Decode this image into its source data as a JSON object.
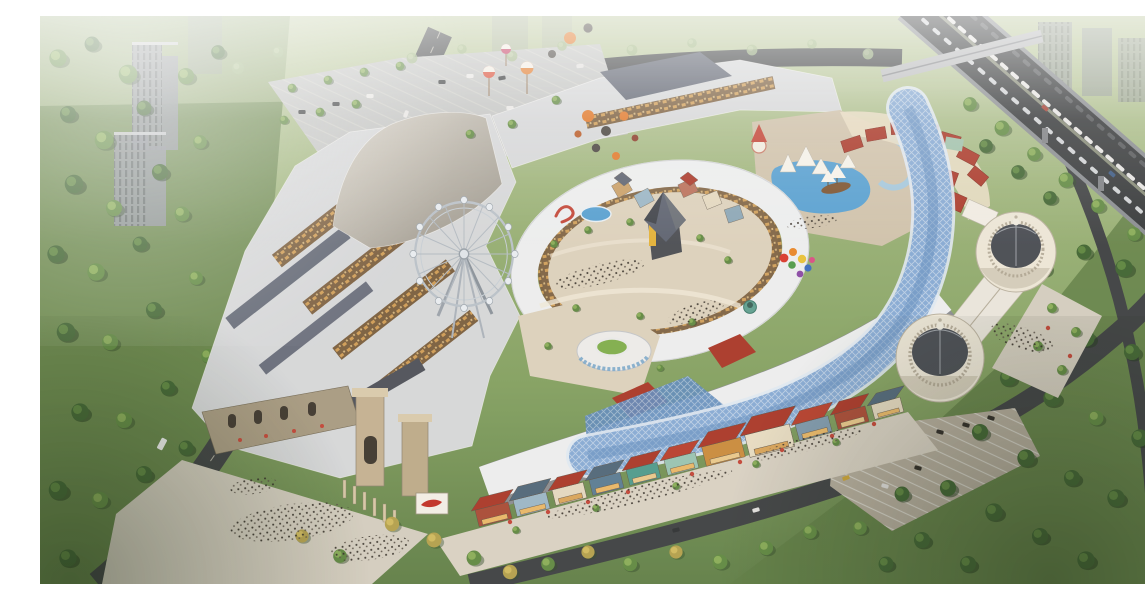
{
  "image": {
    "type": "aerial-architectural-rendering",
    "subject": "Bird's-eye rendering of a large mixed-use shopping and entertainment complex",
    "time_of_day": "late afternoon with warm hazy sunlight from the left",
    "visible_text": "none"
  },
  "scene": {
    "complex_landmarks": [
      {
        "name": "ferris-wheel",
        "where": "left-center of mall",
        "detail": "white lattice wheel with round white gondolas on tall A-frame supports"
      },
      {
        "name": "central-courtyard-ring",
        "where": "center",
        "detail": "C-shaped white roof ring around an oval plaza with playground, blue splash pool and red dinosaur sculpture"
      },
      {
        "name": "pyramid-tower",
        "where": "center of ring",
        "detail": "dark pyramid roof on a tower with a yellow sign band"
      },
      {
        "name": "round-lawn-pavilion",
        "where": "south of ring",
        "detail": "circular pavilion with green lawn disc on its roof"
      },
      {
        "name": "glass-canopy",
        "where": "winding from northeast down to south village",
        "detail": "serpentine blue glass grid canopy"
      },
      {
        "name": "domed-halls",
        "where": "east",
        "detail": "two classical octagonal buildings with dark ribbed domes and lanterns"
      },
      {
        "name": "village-street",
        "where": "south rim",
        "detail": "row of small European houses with red and slate roofs and colorful facades"
      },
      {
        "name": "entrance-gate",
        "where": "southwest",
        "detail": "stone gate towers, colonnade, billboard with red graphic, large plaza with crowds"
      },
      {
        "name": "water-play-zone",
        "where": "northeast of ring",
        "detail": "blue pool with pirate ship, white sail tents and lazy river"
      },
      {
        "name": "balloon-decorations",
        "where": "above north wing and east plaza",
        "detail": "floating orange and charcoal spheres, striped balloon towers, rainbow balloon bunch"
      },
      {
        "name": "west-retail-block",
        "where": "west",
        "detail": "large flat gray/white roofs cut by warm open-air retail canyons"
      },
      {
        "name": "red-roof-arc",
        "where": "northeast rim",
        "detail": "arc of small red hip roofs over cream shops"
      }
    ],
    "surroundings": [
      {
        "name": "elevated-highway",
        "where": "upper right",
        "detail": "diagonal expressway full of traffic with an overpass bridge and piers"
      },
      {
        "name": "residential-towers",
        "where": "top-left and top-right",
        "detail": "tall gray apartment slabs fading into haze"
      },
      {
        "name": "parks",
        "where": "left, bottom and right margins",
        "detail": "dense green tree masses, darker toward bottom corners"
      },
      {
        "name": "surface-roads",
        "where": "perimeter",
        "detail": "tree-lined streets with cars, a bus, and curving south boulevard"
      },
      {
        "name": "parking-lots",
        "where": "northwest and southeast",
        "detail": "striped lots with parked cars and tree rows"
      }
    ],
    "activity": {
      "crowds": "dense visitor dots on gate plaza, village promenade, courtyard and dome plaza",
      "traffic": "two-way queues on the elevated highway, scattered cars on local roads"
    }
  },
  "palette": {
    "grass_light": "#b7c79b",
    "grass_mid": "#8aa768",
    "grass_dark": "#5e7d46",
    "tree_light": "#8fb35e",
    "tree_mid": "#5f8a44",
    "tree_dark": "#3f6534",
    "tree_shadow": "#2e4a28",
    "tree_autumn": "#b3a14f",
    "tree_faded": "#9db685",
    "road": "#3d4145",
    "road_edge": "#82878e",
    "lane_mark": "#d9d5c9",
    "lot": "#c2c5c6",
    "lot_line": "#dcdcd6",
    "roof_white": "#eceff2",
    "roof_light": "#d5d8dc",
    "roof_mid": "#b9bcc2",
    "roof_slate": "#5c6373",
    "roof_dark": "#4d525c",
    "roof_tan_l": "#d8d4ca",
    "roof_tan_d": "#989189",
    "pave_warm": "#dcd2bf",
    "plaza": "#d3cec2",
    "canyon": "#7a5f41",
    "store_warm": "#d9a55c",
    "red_roof": "#a9382b",
    "red_bright": "#c2463a",
    "facade_cream": "#e7ddc5",
    "stone": "#a79b84",
    "stone_dark": "#8c8271",
    "glass": "#86abd7",
    "glass_deep": "#5f8cc0",
    "glass_rim": "#dfe9f5",
    "pool": "#55a0d4",
    "pool_light": "#9cc9e8",
    "dome": "#474c55",
    "dome_hl": "#6a7079",
    "dome_base": "#ece7da",
    "balloon_orange": "#e0792c",
    "balloon_dark": "#474441",
    "highrise": "#8d939b",
    "highrise_dark": "#646a72",
    "crowd_dark": "#332f2a",
    "crowd_mid": "#5a534b",
    "lawn": "#7fae4e",
    "warm_light": "#ffd9a6",
    "white": "#ffffff"
  }
}
